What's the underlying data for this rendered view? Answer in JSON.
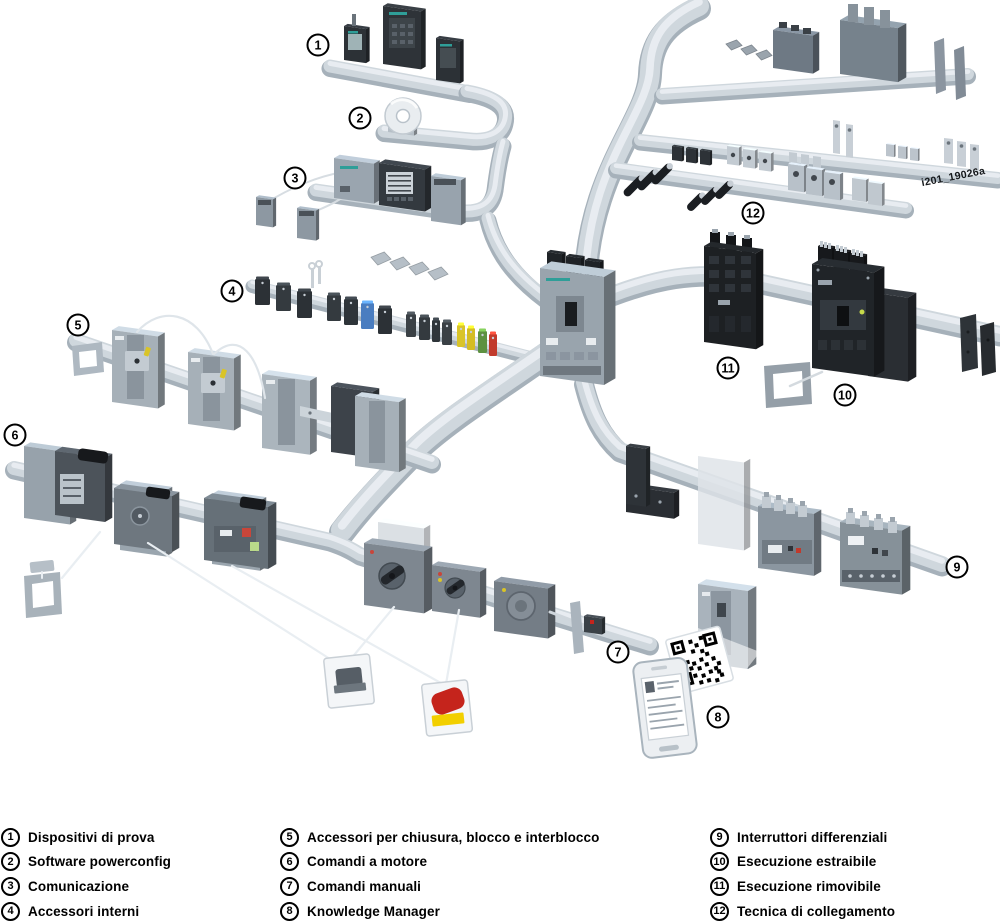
{
  "figure": {
    "watermark": "i201_19026a",
    "background": "#ffffff",
    "description": "Isometric overview of molded-case circuit breaker system with numbered accessory groups on connecting rails"
  },
  "legend": {
    "items": [
      {
        "num": "1",
        "label": "Dispositivi di prova"
      },
      {
        "num": "2",
        "label": "Software powerconfig"
      },
      {
        "num": "3",
        "label": "Comunicazione"
      },
      {
        "num": "4",
        "label": "Accessori interni"
      },
      {
        "num": "5",
        "label": "Accessori per chiusura, blocco e interblocco"
      },
      {
        "num": "6",
        "label": "Comandi a motore"
      },
      {
        "num": "7",
        "label": "Comandi manuali"
      },
      {
        "num": "8",
        "label": "Knowledge Manager"
      },
      {
        "num": "9",
        "label": "Interruttori differenziali"
      },
      {
        "num": "10",
        "label": "Esecuzione estraibile"
      },
      {
        "num": "11",
        "label": "Esecuzione rimovibile"
      },
      {
        "num": "12",
        "label": "Tecnica di collegamento"
      }
    ]
  },
  "products": {
    "1": "test-devices",
    "2": "powerconfig-software-cd",
    "3": "communication-modules",
    "4": "internal-accessories",
    "5": "locking-and-interlock-breakers",
    "6": "motor-operators",
    "7": "manual-rotary-operators",
    "8": "knowledge-manager-phone-qr",
    "9": "residual-current-devices",
    "10": "withdrawable-version-breaker",
    "11": "removable-version-breaker",
    "12": "connection-terminals"
  },
  "colors": {
    "rail": "#cfd7dd",
    "rail_edge": "#a6b1ba",
    "rail_highlight": "#e9edf1",
    "device_dark": "#2c3136",
    "breaker_gray": "#a6b0b8",
    "breaker_black": "#1d2023",
    "module_gray": "#8d98a2",
    "rcd_gray": "#8b96a0",
    "metal": "#c3cbd2",
    "accent_blue": "#4a7dc0",
    "accent_yellow": "#d9c428",
    "accent_green": "#5d9141",
    "accent_red": "#c13a2c",
    "emergency_red": "#c5241c",
    "emergency_yellow": "#f2cf00",
    "teal_label": "#2f9e98",
    "wire": "#e9eef2"
  }
}
